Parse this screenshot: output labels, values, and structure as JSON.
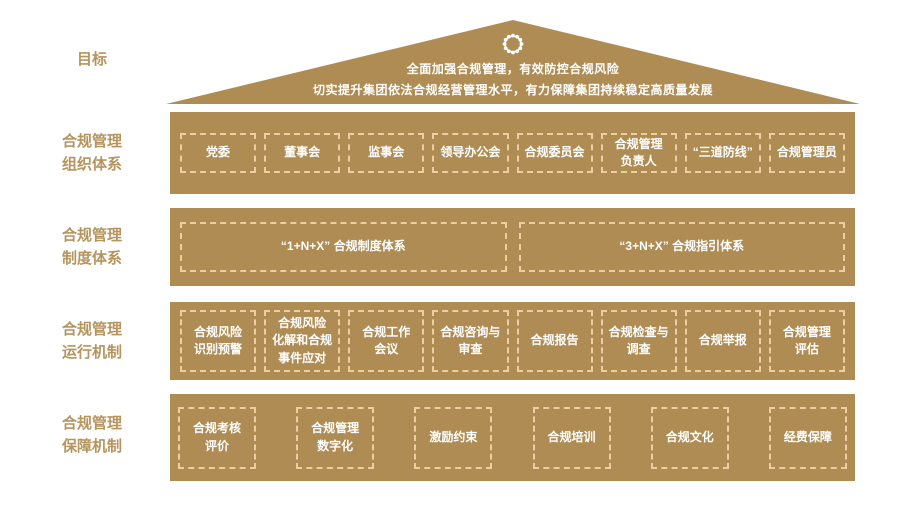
{
  "colors": {
    "band_background": "#af8c53",
    "box_border": "#eecda0",
    "box_text": "#ffffff",
    "side_label_text": "#b6945e",
    "page_background": "#ffffff"
  },
  "icons": {
    "roof_emblem": "gear-seal"
  },
  "goal": {
    "label": "目标",
    "line1": "全面加强合规管理，有效防控合规风险",
    "line2": "切实提升集团依法合规经营管理水平，有力保障集团持续稳定高质量发展"
  },
  "rows": [
    {
      "label": "合规管理\n组织体系",
      "items": [
        "党委",
        "董事会",
        "监事会",
        "领导办公会",
        "合规委员会",
        "合规管理\n负责人",
        "“三道防线”",
        "合规管理员"
      ]
    },
    {
      "label": "合规管理\n制度体系",
      "items": [
        "“1+N+X” 合规制度体系",
        "“3+N+X” 合规指引体系"
      ]
    },
    {
      "label": "合规管理\n运行机制",
      "items": [
        "合规风险\n识别预警",
        "合规风险\n化解和合规\n事件应对",
        "合规工作\n会议",
        "合规咨询与\n审查",
        "合规报告",
        "合规检查与\n调查",
        "合规举报",
        "合规管理\n评估"
      ]
    },
    {
      "label": "合规管理\n保障机制",
      "items": [
        "合规考核\n评价",
        "合规管理\n数字化",
        "激励约束",
        "合规培训",
        "合规文化",
        "经费保障"
      ]
    }
  ]
}
